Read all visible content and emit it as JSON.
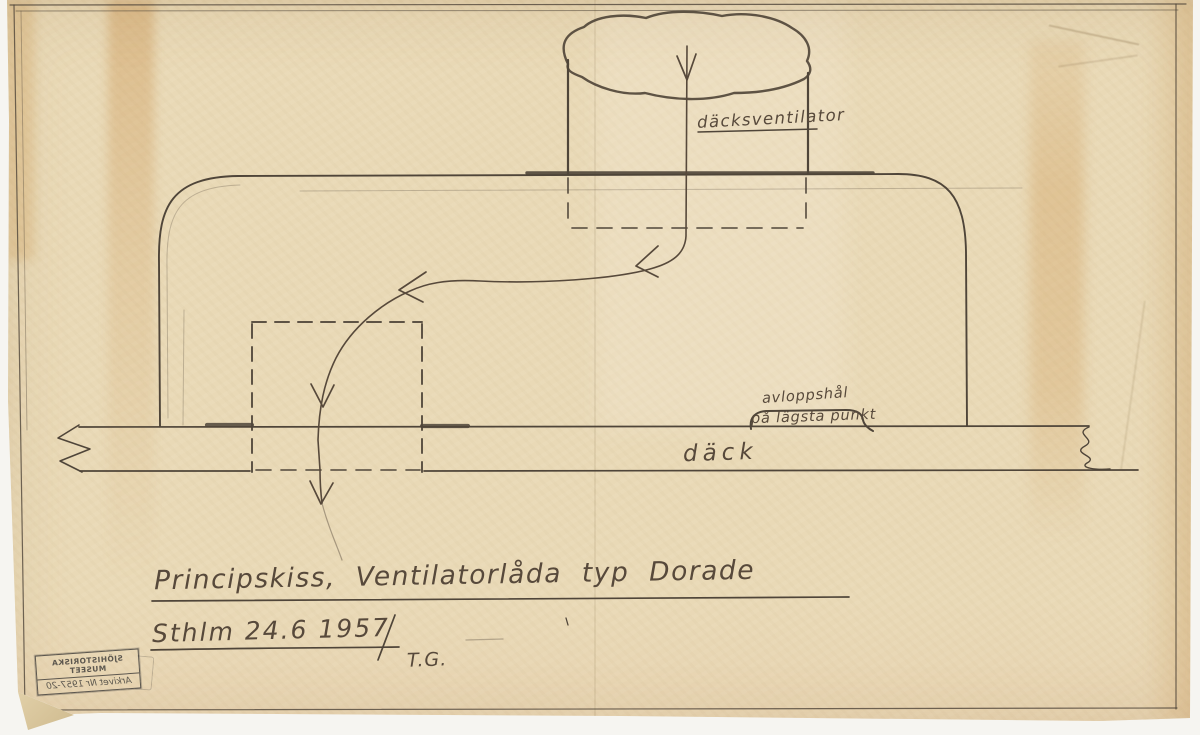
{
  "annotations": {
    "deck_ventilator_label": "däcksventilator",
    "drain_hole_label_line1": "avloppshål",
    "drain_hole_label_line2": "på lägsta punkt",
    "deck_label": "däck"
  },
  "title_block": {
    "title": "Principskiss, Ventilatorlåda typ Dorade",
    "place_and_date": "Sthlm 24.6 1957",
    "signature": "T.G."
  },
  "stamp": {
    "museum_name": "SJÖHISTORISKA MUSEET",
    "archive_line": "Arkivet Nr 1957-20",
    "mirrored": true
  },
  "colors": {
    "paper": "#e9d9b6",
    "pencil": "#4b4237",
    "handwriting": "#57493b",
    "stamp_ink": "#45423e",
    "stain": "#c8883e"
  }
}
